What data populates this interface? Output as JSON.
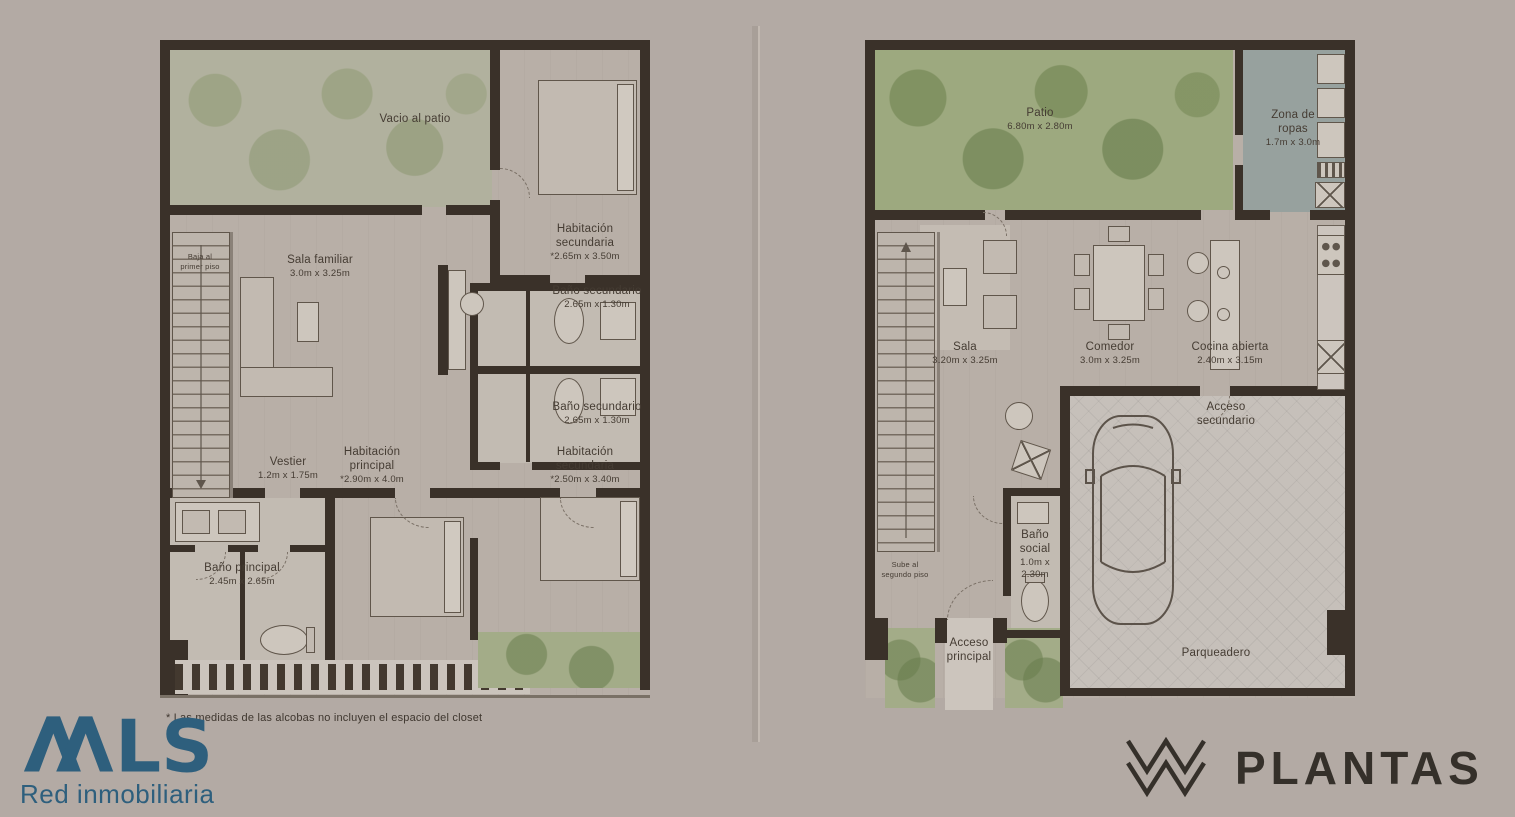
{
  "page": {
    "background": "#b3aaa4"
  },
  "colors": {
    "wall": "#3a3129",
    "patio_green": "#9da97f",
    "shower_green": "#8e9a8d",
    "laundry_blue": "#97a19e",
    "mls_teal": "#2e5f7d",
    "plantas_dark": "#35302a"
  },
  "footnote": "* Las medidas de las alcobas no incluyen el espacio del closet",
  "branding": {
    "mls": {
      "name": "MLS",
      "tagline": "Red inmobiliaria",
      "color": "#2e5f7d"
    },
    "plantas": {
      "name": "PLANTAS",
      "color": "#35302a"
    }
  },
  "left_plan": {
    "title": "segundo piso",
    "rooms": {
      "vacio": {
        "label": "Vacio al patio"
      },
      "hab_sec_1": {
        "label": "Habitación secundaria",
        "dims": "*2.65m x 3.50m"
      },
      "bano_sec_1": {
        "label": "Baño secundario",
        "dims": "2.65m x 1.30m"
      },
      "sala_familiar": {
        "label": "Sala familiar",
        "dims": "3.0m x 3.25m"
      },
      "bano_sec_2": {
        "label": "Baño secundario",
        "dims": "2.65m x 1.30m"
      },
      "vestier": {
        "label": "Vestier",
        "dims": "1.2m x 1.75m"
      },
      "hab_principal": {
        "label": "Habitación principal",
        "dims": "*2.90m x 4.0m"
      },
      "hab_sec_2": {
        "label": "Habitación secundaria",
        "dims": "*2.50m x 3.40m"
      },
      "bano_principal": {
        "label": "Baño principal",
        "dims": "2.45m x 2.65m"
      },
      "stairs": {
        "label": "Baja al primer piso"
      }
    }
  },
  "right_plan": {
    "title": "primer piso",
    "rooms": {
      "patio": {
        "label": "Patio",
        "dims": "6.80m x 2.80m"
      },
      "zona_ropas": {
        "label": "Zona de ropas",
        "dims": "1.7m x 3.0m"
      },
      "sala": {
        "label": "Sala",
        "dims": "3.20m x 3.25m"
      },
      "comedor": {
        "label": "Comedor",
        "dims": "3.0m x 3.25m"
      },
      "cocina": {
        "label": "Cocina abierta",
        "dims": "2.40m x 3.15m"
      },
      "acceso_secundario": {
        "label": "Acceso secundario"
      },
      "bano_social": {
        "label": "Baño social",
        "dims": "1.0m x 2.30m"
      },
      "stairs": {
        "label": "Sube al segundo piso"
      },
      "acceso_principal": {
        "label": "Acceso principal"
      },
      "parqueadero": {
        "label": "Parqueadero"
      }
    }
  }
}
